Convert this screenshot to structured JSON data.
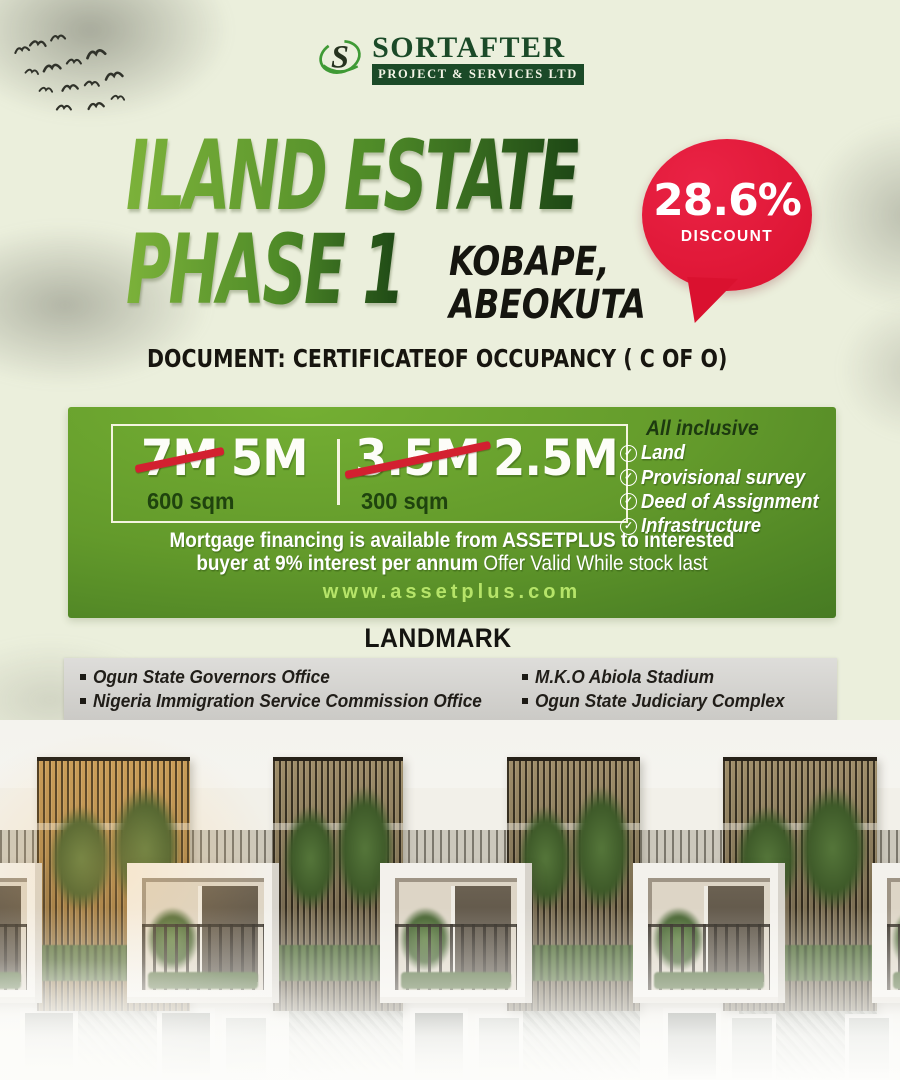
{
  "logo": {
    "brand": "SORTAFTER",
    "tagline": "PROJECT & SERVICES LTD"
  },
  "hero": {
    "title_line1": "ILAND ESTATE",
    "title_line2": "PHASE 1",
    "location_line1": "KOBAPE,",
    "location_line2": "ABEOKUTA",
    "document_line": "DOCUMENT: CERTIFICATEOF OCCUPANCY ( C OF O)"
  },
  "discount_badge": {
    "value": "28.6%",
    "label": "DISCOUNT"
  },
  "offer": {
    "plots": [
      {
        "old_price": "7M",
        "new_price": "5M",
        "size": "600 sqm"
      },
      {
        "old_price": "3.5M",
        "new_price": "2.5M",
        "size": "300 sqm"
      }
    ],
    "inclusive_title": "All inclusive",
    "inclusive_items": [
      "Land",
      "Provisional survey",
      "Deed of Assignment",
      "Infrastructure"
    ],
    "mortgage_line1": "Mortgage financing is available from ASSETPLUS to interested",
    "mortgage_line2_bold": "buyer at 9% interest per annum",
    "mortgage_line2_regular": "Offer Valid While stock last",
    "website": "www.assetplus.com"
  },
  "landmarks": {
    "heading": "LANDMARK",
    "column_left": [
      "Ogun State Governors Office",
      "Nigeria Immigration Service Commission Office"
    ],
    "column_right": [
      "M.K.O Abiola Stadium",
      "Ogun State Judiciary Complex"
    ]
  },
  "colors": {
    "background": "#ebefdc",
    "badge_red": "#da112f",
    "panel_green": "#5d9428",
    "title_green_light": "#7cb23a",
    "title_green_dark": "#1d4715",
    "url_green": "#b6e469",
    "logo_green": "#1b4a28"
  }
}
